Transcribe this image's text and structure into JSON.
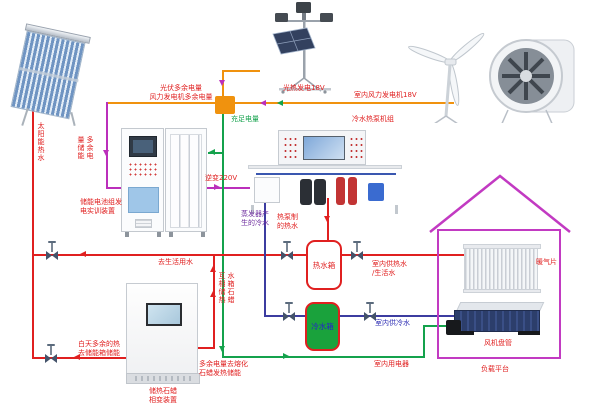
{
  "colors": {
    "electric_orange": "#f0920e",
    "electric_green": "#14a24c",
    "electric_magenta": "#bb2fbb",
    "hot_water_red": "#e02020",
    "cold_water_blue": "#3c3ca0",
    "house_outline": "#c23ac2",
    "cold_tank_fill": "#1aa23c"
  },
  "power": {
    "pv_excess": "光伏多余电量\n风力发电机多余电量",
    "solar_gen": "光热发电18V",
    "wind_gen": "室内风力发电机18V",
    "sufficient": "充足电量",
    "inverter": "逆变220V",
    "excess_store": "多余电量储能",
    "indoor_loads": "室内用电器",
    "melt_paraffin": "多余电量去熔化\n石蜡发热储能"
  },
  "water": {
    "solar_hot": "太阳能热水",
    "to_domestic": "去生活用水",
    "daytime_excess": "白天多余的热\n去储能箱储能",
    "tank_paraffin_mutual": "水箱石蜡互相储热",
    "hp_hot": "热泵制\n的热水",
    "evap_cold": "蒸发器产\n生的冷水",
    "indoor_hot": "室内供热水\n/生活水",
    "indoor_cold": "室内供冷水"
  },
  "devices": {
    "battery_cabinet": "储能电池组发\n电实训装置",
    "heat_pump": "冷水热泵机组",
    "paraffin_unit": "储热石蜡\n相变装置",
    "hot_tank": "热水箱",
    "cold_tank": "冷水箱",
    "radiator": "暖气片",
    "fan_coil": "风机盘管",
    "load_platform": "负载平台"
  }
}
